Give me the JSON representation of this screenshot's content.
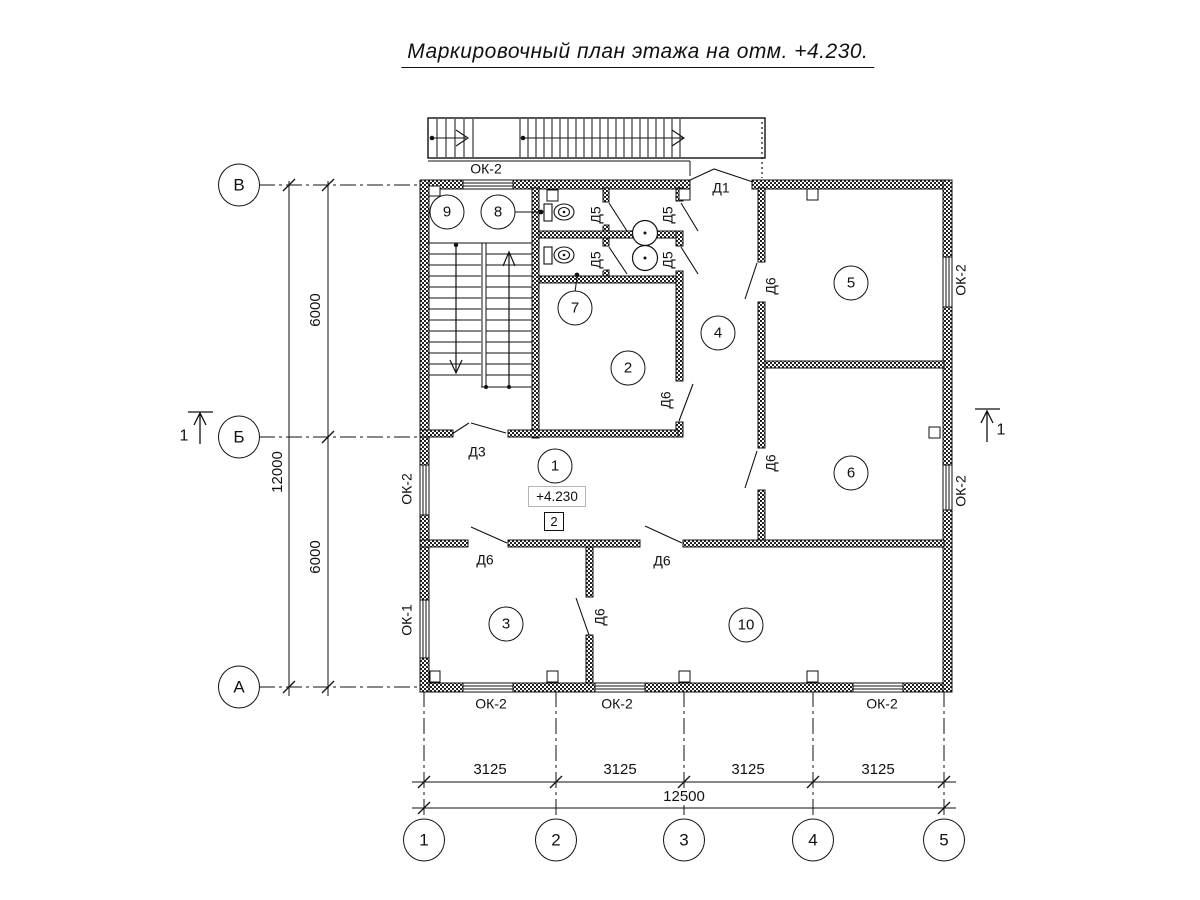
{
  "title": "Маркировочный план этажа на отм. +4.230.",
  "elevation": {
    "value": "+4.230",
    "zone_number": "2"
  },
  "axes": {
    "rows": [
      {
        "label": "В",
        "x": 239,
        "y": 185
      },
      {
        "label": "Б",
        "x": 239,
        "y": 437
      },
      {
        "label": "А",
        "x": 239,
        "y": 687
      }
    ],
    "cols": [
      {
        "label": "1",
        "x": 424,
        "y": 840
      },
      {
        "label": "2",
        "x": 556,
        "y": 840
      },
      {
        "label": "3",
        "x": 684,
        "y": 840
      },
      {
        "label": "4",
        "x": 813,
        "y": 840
      },
      {
        "label": "5",
        "x": 944,
        "y": 840
      }
    ]
  },
  "rooms": [
    {
      "number": "1",
      "x": 555,
      "y": 466
    },
    {
      "number": "2",
      "x": 628,
      "y": 368
    },
    {
      "number": "3",
      "x": 506,
      "y": 624
    },
    {
      "number": "4",
      "x": 718,
      "y": 333
    },
    {
      "number": "5",
      "x": 851,
      "y": 283
    },
    {
      "number": "6",
      "x": 851,
      "y": 473
    },
    {
      "number": "7",
      "x": 575,
      "y": 308
    },
    {
      "number": "8",
      "x": 498,
      "y": 212
    },
    {
      "number": "9",
      "x": 447,
      "y": 212
    },
    {
      "number": "10",
      "x": 746,
      "y": 625
    }
  ],
  "labels": [
    {
      "text": "Д1",
      "x": 721,
      "y": 188,
      "rot": 0,
      "kind": "door"
    },
    {
      "text": "Д3",
      "x": 477,
      "y": 452,
      "rot": 0,
      "kind": "door"
    },
    {
      "text": "Д5",
      "x": 596,
      "y": 215,
      "rot": -90,
      "kind": "door"
    },
    {
      "text": "Д5",
      "x": 668,
      "y": 215,
      "rot": -90,
      "kind": "door"
    },
    {
      "text": "Д5",
      "x": 596,
      "y": 260,
      "rot": -90,
      "kind": "door"
    },
    {
      "text": "Д5",
      "x": 668,
      "y": 260,
      "rot": -90,
      "kind": "door"
    },
    {
      "text": "Д6",
      "x": 771,
      "y": 286,
      "rot": -90,
      "kind": "door"
    },
    {
      "text": "Д6",
      "x": 666,
      "y": 400,
      "rot": -90,
      "kind": "door"
    },
    {
      "text": "Д6",
      "x": 771,
      "y": 463,
      "rot": -90,
      "kind": "door"
    },
    {
      "text": "Д6",
      "x": 485,
      "y": 560,
      "rot": 0,
      "kind": "door"
    },
    {
      "text": "Д6",
      "x": 662,
      "y": 561,
      "rot": 0,
      "kind": "door"
    },
    {
      "text": "Д6",
      "x": 600,
      "y": 617,
      "rot": -90,
      "kind": "door"
    },
    {
      "text": "ОК-2",
      "x": 486,
      "y": 169,
      "rot": 0,
      "kind": "window"
    },
    {
      "text": "ОК-2",
      "x": 407,
      "y": 489,
      "rot": -90,
      "kind": "window"
    },
    {
      "text": "ОК-1",
      "x": 407,
      "y": 620,
      "rot": -90,
      "kind": "window"
    },
    {
      "text": "ОК-2",
      "x": 961,
      "y": 280,
      "rot": -90,
      "kind": "window"
    },
    {
      "text": "ОК-2",
      "x": 961,
      "y": 491,
      "rot": -90,
      "kind": "window"
    },
    {
      "text": "ОК-2",
      "x": 491,
      "y": 704,
      "rot": 0,
      "kind": "window"
    },
    {
      "text": "ОК-2",
      "x": 617,
      "y": 704,
      "rot": 0,
      "kind": "window"
    },
    {
      "text": "ОК-2",
      "x": 882,
      "y": 704,
      "rot": 0,
      "kind": "window"
    }
  ],
  "dimensions": [
    {
      "text": "6000",
      "x": 316,
      "y": 310,
      "rot": -90
    },
    {
      "text": "12000",
      "x": 278,
      "y": 472,
      "rot": -90
    },
    {
      "text": "6000",
      "x": 316,
      "y": 557,
      "rot": -90
    },
    {
      "text": "3125",
      "x": 490,
      "y": 770,
      "rot": 0
    },
    {
      "text": "3125",
      "x": 620,
      "y": 770,
      "rot": 0
    },
    {
      "text": "3125",
      "x": 748,
      "y": 770,
      "rot": 0
    },
    {
      "text": "3125",
      "x": 878,
      "y": 770,
      "rot": 0
    },
    {
      "text": "12500",
      "x": 684,
      "y": 797,
      "rot": 0
    }
  ],
  "section_marks": [
    {
      "label": "1",
      "x": 184,
      "y": 437
    },
    {
      "label": "1",
      "x": 1001,
      "y": 431
    }
  ]
}
